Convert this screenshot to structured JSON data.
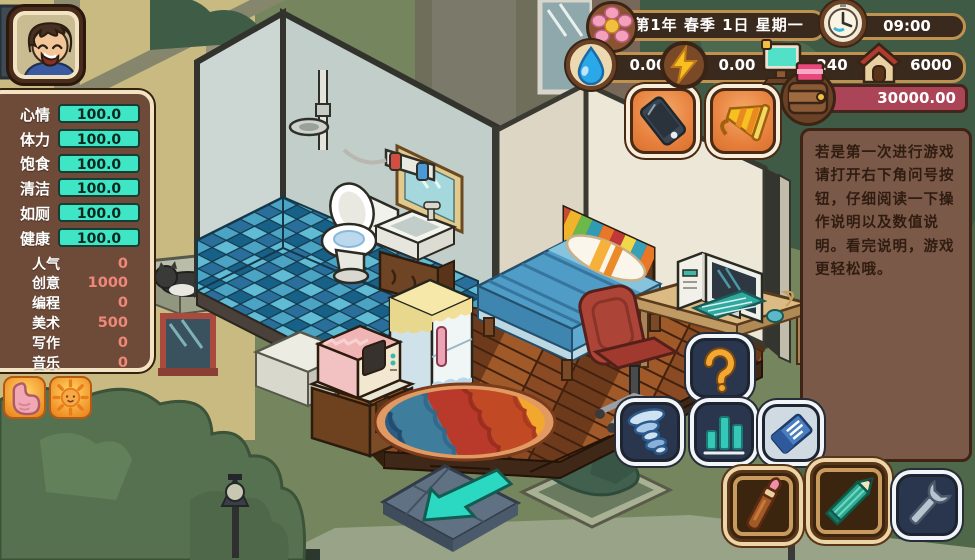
{
  "window": {
    "title": "life-sim-room-game"
  },
  "stats": {
    "rows": [
      {
        "label": "心情",
        "value": "100.0"
      },
      {
        "label": "体力",
        "value": "100.0"
      },
      {
        "label": "饱食",
        "value": "100.0"
      },
      {
        "label": "清洁",
        "value": "100.0"
      },
      {
        "label": "如厕",
        "value": "100.0"
      },
      {
        "label": "健康",
        "value": "100.0"
      }
    ]
  },
  "skills": {
    "rows": [
      {
        "label": "人气",
        "value": "0"
      },
      {
        "label": "创意",
        "value": "1000"
      },
      {
        "label": "编程",
        "value": "0"
      },
      {
        "label": "美术",
        "value": "500"
      },
      {
        "label": "写作",
        "value": "0"
      },
      {
        "label": "音乐",
        "value": "0"
      }
    ]
  },
  "topbar": {
    "date": "第1年 春季 1日 星期一",
    "time": "09:00"
  },
  "resources": {
    "water": "0.00",
    "power": "0.00",
    "computer": "240",
    "house": "6000"
  },
  "wallet": {
    "balance": "30000.00"
  },
  "notice": {
    "text": "若是第一次进行游戏请打开右下角问号按钮，仔细阅读一下操作说明以及数值说明。看完说明，游戏更轻松哦。"
  },
  "colors": {
    "stat_teal": "#3fe6c5",
    "skill_value": "#f0887a",
    "money_bar": "#ac4458",
    "hud_bar": "#3a2a1d",
    "hud_border": "#c0914f",
    "panel_brown": "#6e4a38",
    "notice_brown": "#7b5949",
    "button_orange": "#e8823f",
    "button_navy": "#29364e"
  },
  "icons": {
    "list": [
      "boy-avatar",
      "flower-icon",
      "clock-icon",
      "water-drop-icon",
      "lightning-icon",
      "computer-icon",
      "house-icon",
      "wallet-icon",
      "phone-icon",
      "megaphone-icon",
      "question-icon",
      "tornado-icon",
      "bar-chart-icon",
      "ticket-icon",
      "paintbrush-icon",
      "pencil-icon",
      "wrench-icon",
      "stomach-icon",
      "sun-icon",
      "exit-arrow"
    ]
  }
}
